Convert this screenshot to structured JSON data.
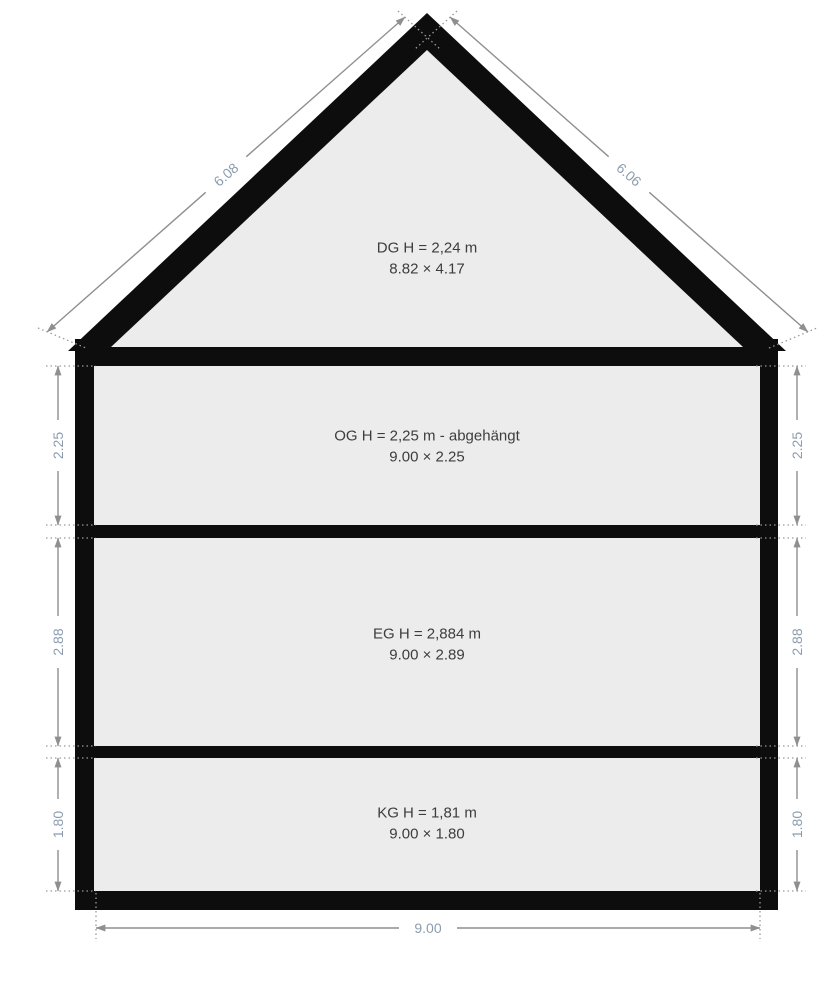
{
  "diagram_title": "building-cross-section",
  "floors": [
    {
      "id": "DG",
      "label": "DG H = 2,24 m",
      "size": "8.82 × 4.17"
    },
    {
      "id": "OG",
      "label": "OG H = 2,25 m - abgehängt",
      "size": "9.00 × 2.25"
    },
    {
      "id": "EG",
      "label": "EG H = 2,884 m",
      "size": "9.00 × 2.89"
    },
    {
      "id": "KG",
      "label": "KG H = 1,81 m",
      "size": "9.00 × 1.80"
    }
  ],
  "dimensions": {
    "roof_left": "6.08",
    "roof_right": "6.06",
    "og_left": "2.25",
    "og_right": "2.25",
    "eg_left": "2.88",
    "eg_right": "2.88",
    "kg_left": "1.80",
    "kg_right": "1.80",
    "total_width": "9.00"
  },
  "colors": {
    "structure": "#0d0d0d",
    "interior": "#ececec",
    "dimension_line": "#8f8f8f",
    "dimension_text": "#8c9cae",
    "label_text": "#3d3d3d",
    "background": "#ffffff"
  }
}
